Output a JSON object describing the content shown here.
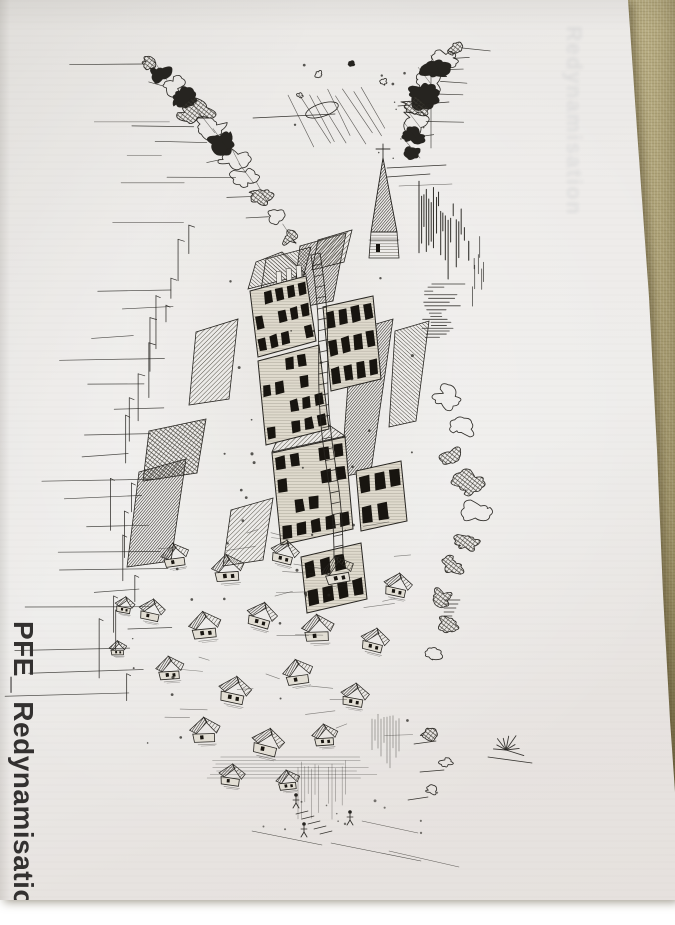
{
  "photo": {
    "caption_vertical_text": "PFE_ Redynamisation",
    "showthrough_faint_text": "Redynamisation",
    "illustration_alt": "Intricate black ink sketch of a cascading hillside village: scratchy tree canopies at the top, a thin church spire with a cross, stacked tower facades filled with tiny dark windows, clusters of gabled roofs below, and scattered figures and strokes tapering to the bottom",
    "colors": {
      "ink": "#262420",
      "paper": "#ebe9e6",
      "fabric_background": "#b1a67b"
    }
  }
}
